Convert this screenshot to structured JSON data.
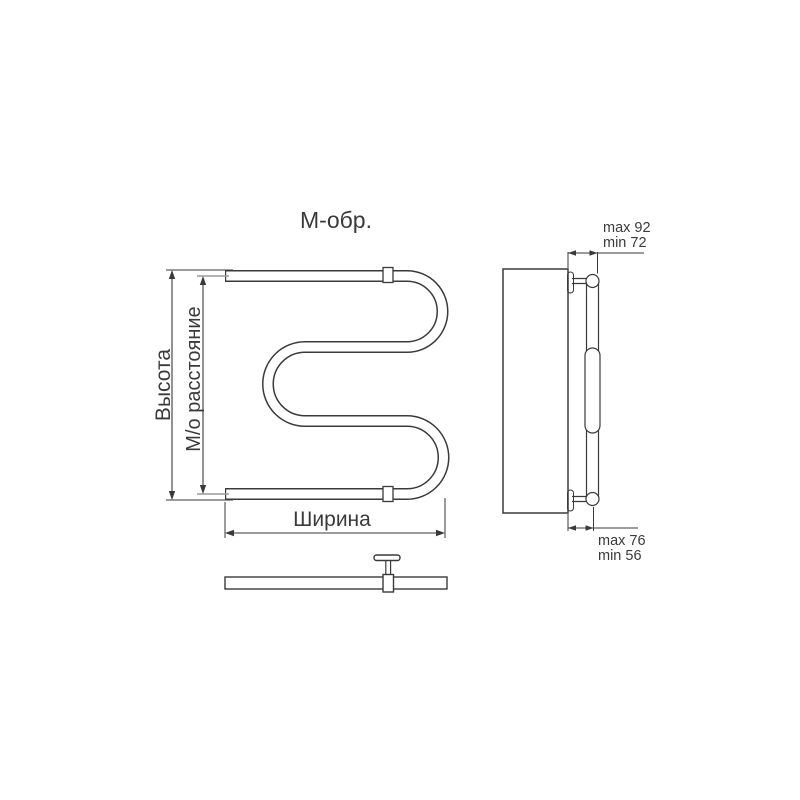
{
  "title": "М-обр.",
  "colors": {
    "line": "#3a3a3a",
    "wall_fill": "#c9c9c9",
    "pipe_fill": "#ffffff",
    "background": "#ffffff"
  },
  "front_view": {
    "height_label": "Высота",
    "center_distance_label": "М/о расстояние",
    "width_label": "Ширина"
  },
  "side_view": {
    "top_offset_max": "max 92",
    "top_offset_min": "min 72",
    "bottom_offset_max": "max 76",
    "bottom_offset_min": "min 56"
  }
}
